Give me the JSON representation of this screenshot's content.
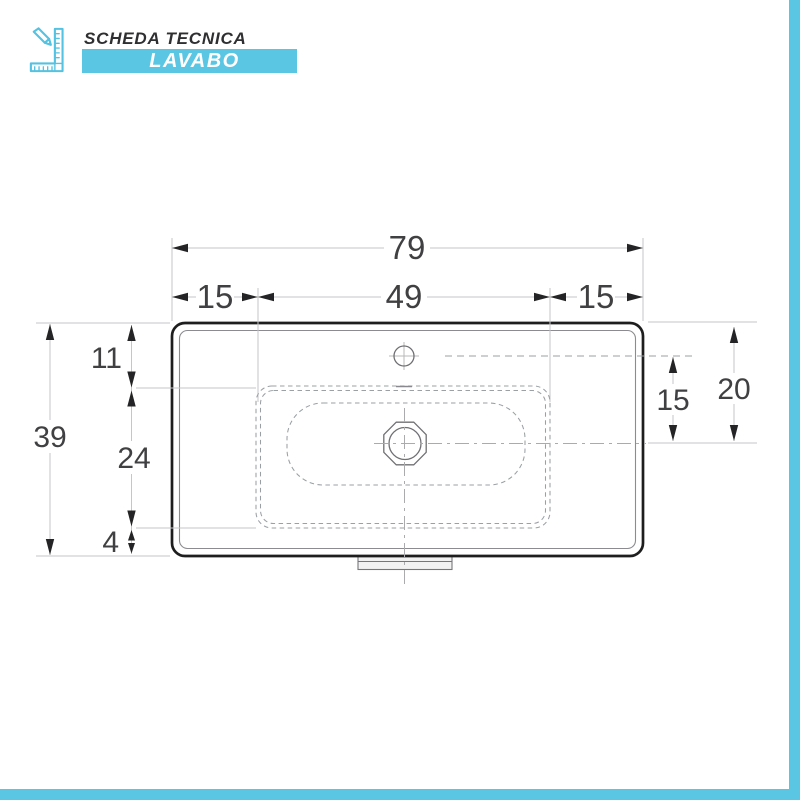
{
  "header": {
    "title": "SCHEDA TECNICA",
    "banner_label": "LAVABO",
    "icon": "pencil-ruler-icon"
  },
  "colors": {
    "accent": "#5bc6e4",
    "outline_dark": "#1e1e1f",
    "dimension_text": "#404042"
  },
  "drawing": {
    "type": "washbasin-top-view-technical-drawing",
    "dimensions": {
      "total_width": "79",
      "left_edge_to_bowl": "15",
      "bowl_width": "49",
      "bowl_to_right_edge": "15",
      "top_edge_to_bowl": "11",
      "bowl_depth": "24",
      "bowl_to_bottom_edge": "4",
      "total_depth": "39",
      "faucet_to_drain": "15",
      "top_edge_to_drain": "20"
    }
  }
}
